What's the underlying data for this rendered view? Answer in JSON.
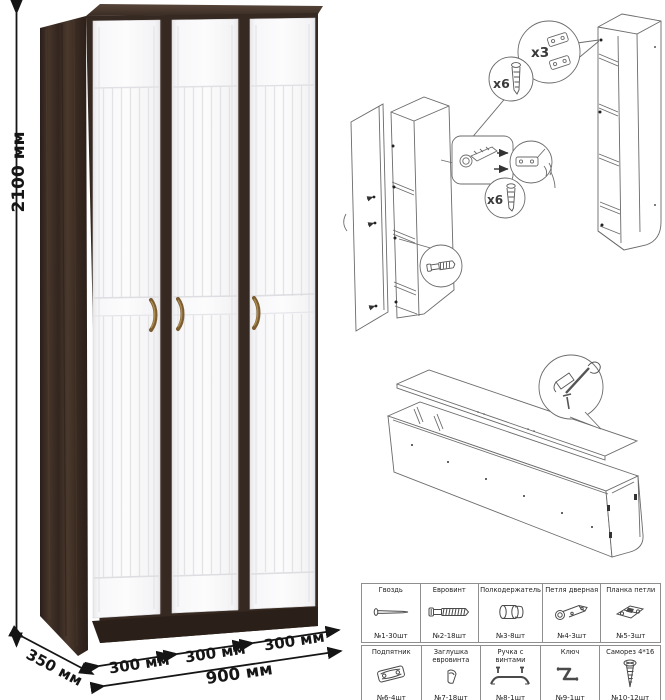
{
  "dimensions": {
    "height": "2100 мм",
    "depth": "350 мм",
    "door1": "300 мм",
    "door2": "300 мм",
    "door3": "300 мм",
    "total_width": "900 мм"
  },
  "assembly": {
    "hinge_plates_count": "x3",
    "screws_count_a": "x6",
    "screws_count_b": "x6"
  },
  "hardware_table": {
    "items": [
      {
        "name": "Гвоздь",
        "count": "№1-30шт",
        "icon": "nail-icon"
      },
      {
        "name": "Евровинт",
        "count": "№2-18шт",
        "icon": "euroscrew-icon"
      },
      {
        "name": "Полкодержатель",
        "count": "№3-8шт",
        "icon": "shelf-pin-icon"
      },
      {
        "name": "Петля дверная",
        "count": "№4-3шт",
        "icon": "door-hinge-icon"
      },
      {
        "name": "Планка петли",
        "count": "№5-3шт",
        "icon": "hinge-plate-icon"
      },
      {
        "name": "Подпятник",
        "count": "№6-4шт",
        "icon": "foot-glide-icon"
      },
      {
        "name": "Заглушка евровинта",
        "count": "№7-18шт",
        "icon": "screw-cap-icon"
      },
      {
        "name": "Ручка с винтами",
        "count": "№8-1шт",
        "icon": "handle-icon"
      },
      {
        "name": "Ключ",
        "count": "№9-1шт",
        "icon": "hex-key-icon"
      },
      {
        "name": "Саморез 4*16",
        "count": "№10-12шт",
        "icon": "self-tapping-screw-icon"
      }
    ]
  },
  "colors": {
    "wood_dark": "#3b2d27",
    "wood_side": "#46362e",
    "door_white": "#f8f8f9",
    "handle_bronze": "#8a6a3a",
    "line_art": "#6b6b6b",
    "dimension_text": "#151515",
    "table_border": "#8f8f8f"
  }
}
